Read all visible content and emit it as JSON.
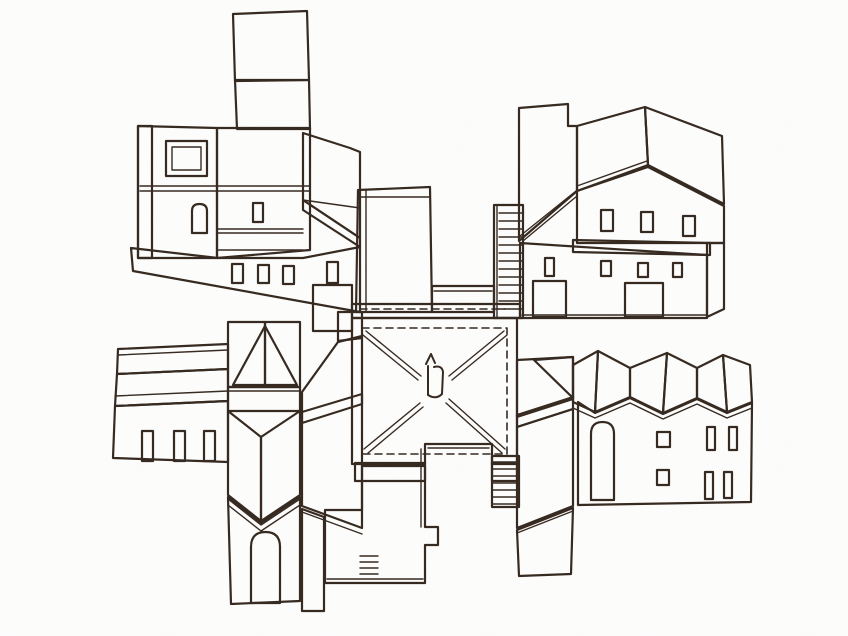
{
  "scene": {
    "type": "watercolor-architectural-sketch",
    "description": "Hand-drawn ink and watercolor drawing of buildings unfolded around a central square courtyard with crossed paving lines, stairs, and a small central monument",
    "parts": [
      "top-left-tower-block",
      "top-right-hip-roof-hall",
      "east-sawtooth-wing",
      "south-tower",
      "west-long-house",
      "central-courtyard"
    ]
  },
  "palette": {
    "paper": "#ffffff",
    "ink": "#33271e",
    "salmon": "#c98a6f",
    "salmonDeep": "#c07f66",
    "salmonLight": "#e0ac91",
    "salmonPale": "#e7bda3",
    "brownDark": "#7d5c48",
    "brownMid": "#8d6850",
    "beige": "#d8c6a6",
    "khaki": "#c3b190",
    "floor": "#dfc7ac",
    "doorGray": "#93897a",
    "doorTan": "#8e8166",
    "windowDark": "#847a66",
    "grainTint": "#6b5a49"
  }
}
